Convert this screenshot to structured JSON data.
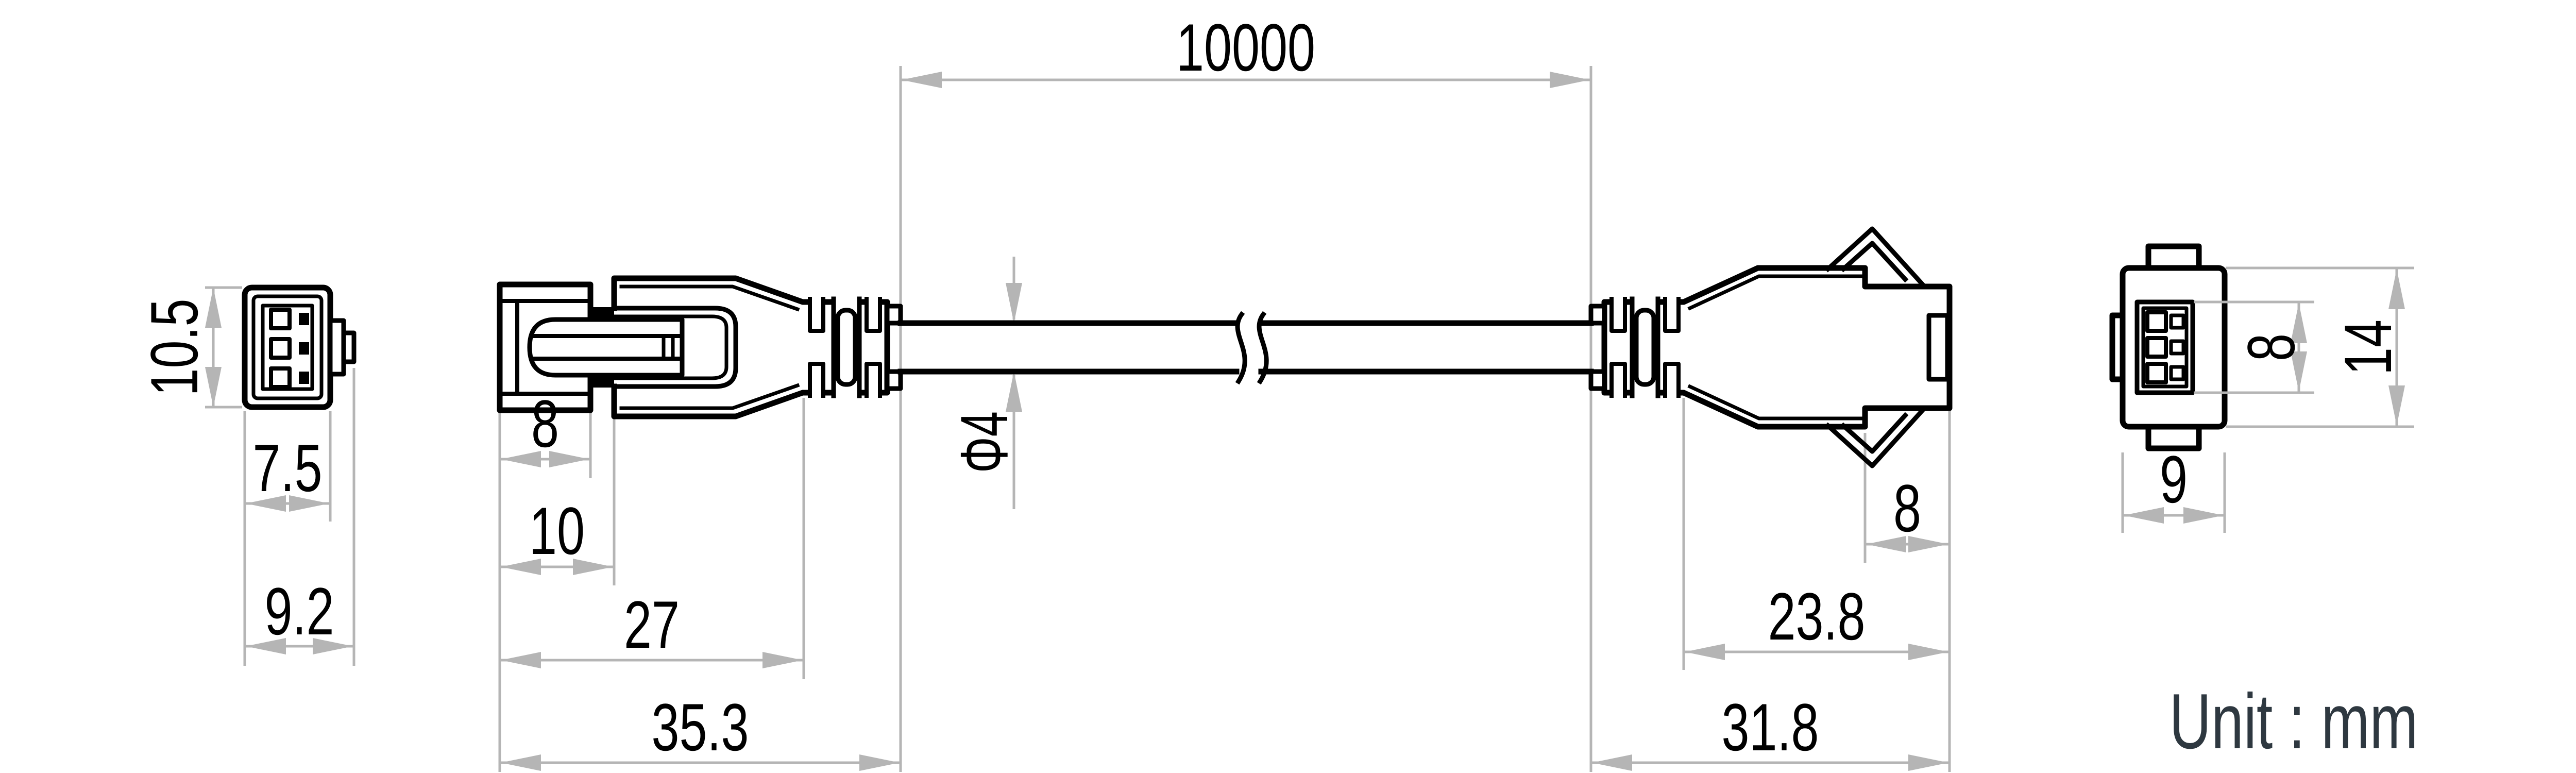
{
  "drawing": {
    "title": "cable-assembly-technical-drawing",
    "unit_label": "Unit : mm",
    "colors": {
      "line": "#000000",
      "dimension_line": "#b5b5b5",
      "unit_text": "#2e3840",
      "background": "#ffffff"
    },
    "dims": {
      "front_left": {
        "height": "10.5",
        "width": "7.5",
        "overall_width": "9.2"
      },
      "side_left": {
        "cap_width": "8",
        "housing_offset": "10",
        "body_length": "27",
        "overall_length": "35.3"
      },
      "cable": {
        "length": "10000",
        "diameter": "Φ4"
      },
      "side_right": {
        "tip_length": "8",
        "body_length": "23.8",
        "overall_length": "31.8"
      },
      "front_right": {
        "inner_height": "8",
        "height": "14",
        "width": "9"
      }
    }
  }
}
